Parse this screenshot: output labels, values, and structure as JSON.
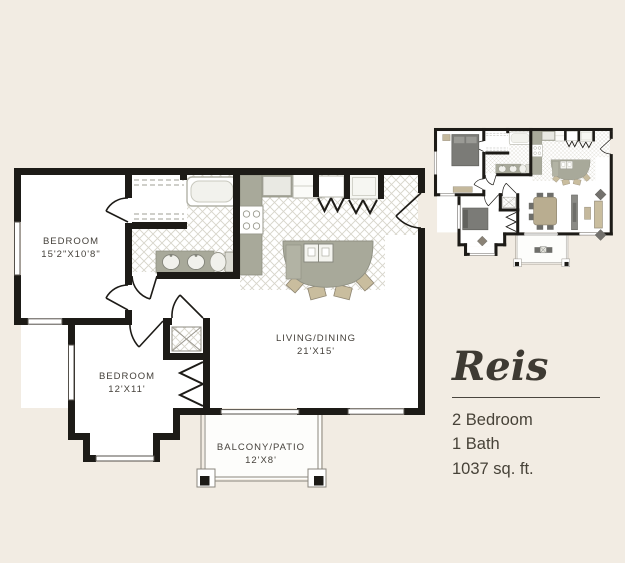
{
  "page": {
    "background_color": "#f2ece3"
  },
  "floorplan": {
    "name": "Reis",
    "details": {
      "beds": "2 Bedroom",
      "baths": "1 Bath",
      "area": "1037 sq. ft."
    },
    "rooms": [
      {
        "label": "BEDROOM",
        "dimensions": "15'2\"X10'8\""
      },
      {
        "label": "BEDROOM",
        "dimensions": "12'X11'"
      },
      {
        "label": "LIVING/DINING",
        "dimensions": "21'X15'"
      },
      {
        "label": "BALCONY/PATIO",
        "dimensions": "12'X8'"
      }
    ],
    "fixtures": [
      "bathtub",
      "vanity-double-sink",
      "toilet",
      "stove",
      "dishwasher",
      "refrigerator",
      "kitchen-island",
      "bar-stools",
      "washer-dryer",
      "closet-shelves",
      "entry-closets-bifold",
      "bedroom-closet-bifold",
      "bay-window",
      "balcony-posts",
      "entry-door"
    ],
    "colors": {
      "background": "#f2ece3",
      "walls": "#1d1b17",
      "tile_line": "#d7d4ca",
      "counter_gray": "#a8a99a",
      "wood_tan": "#c9bd9e",
      "furniture_dark": "#73716d",
      "text": "#45413b",
      "title_text": "#3e3a33"
    }
  }
}
